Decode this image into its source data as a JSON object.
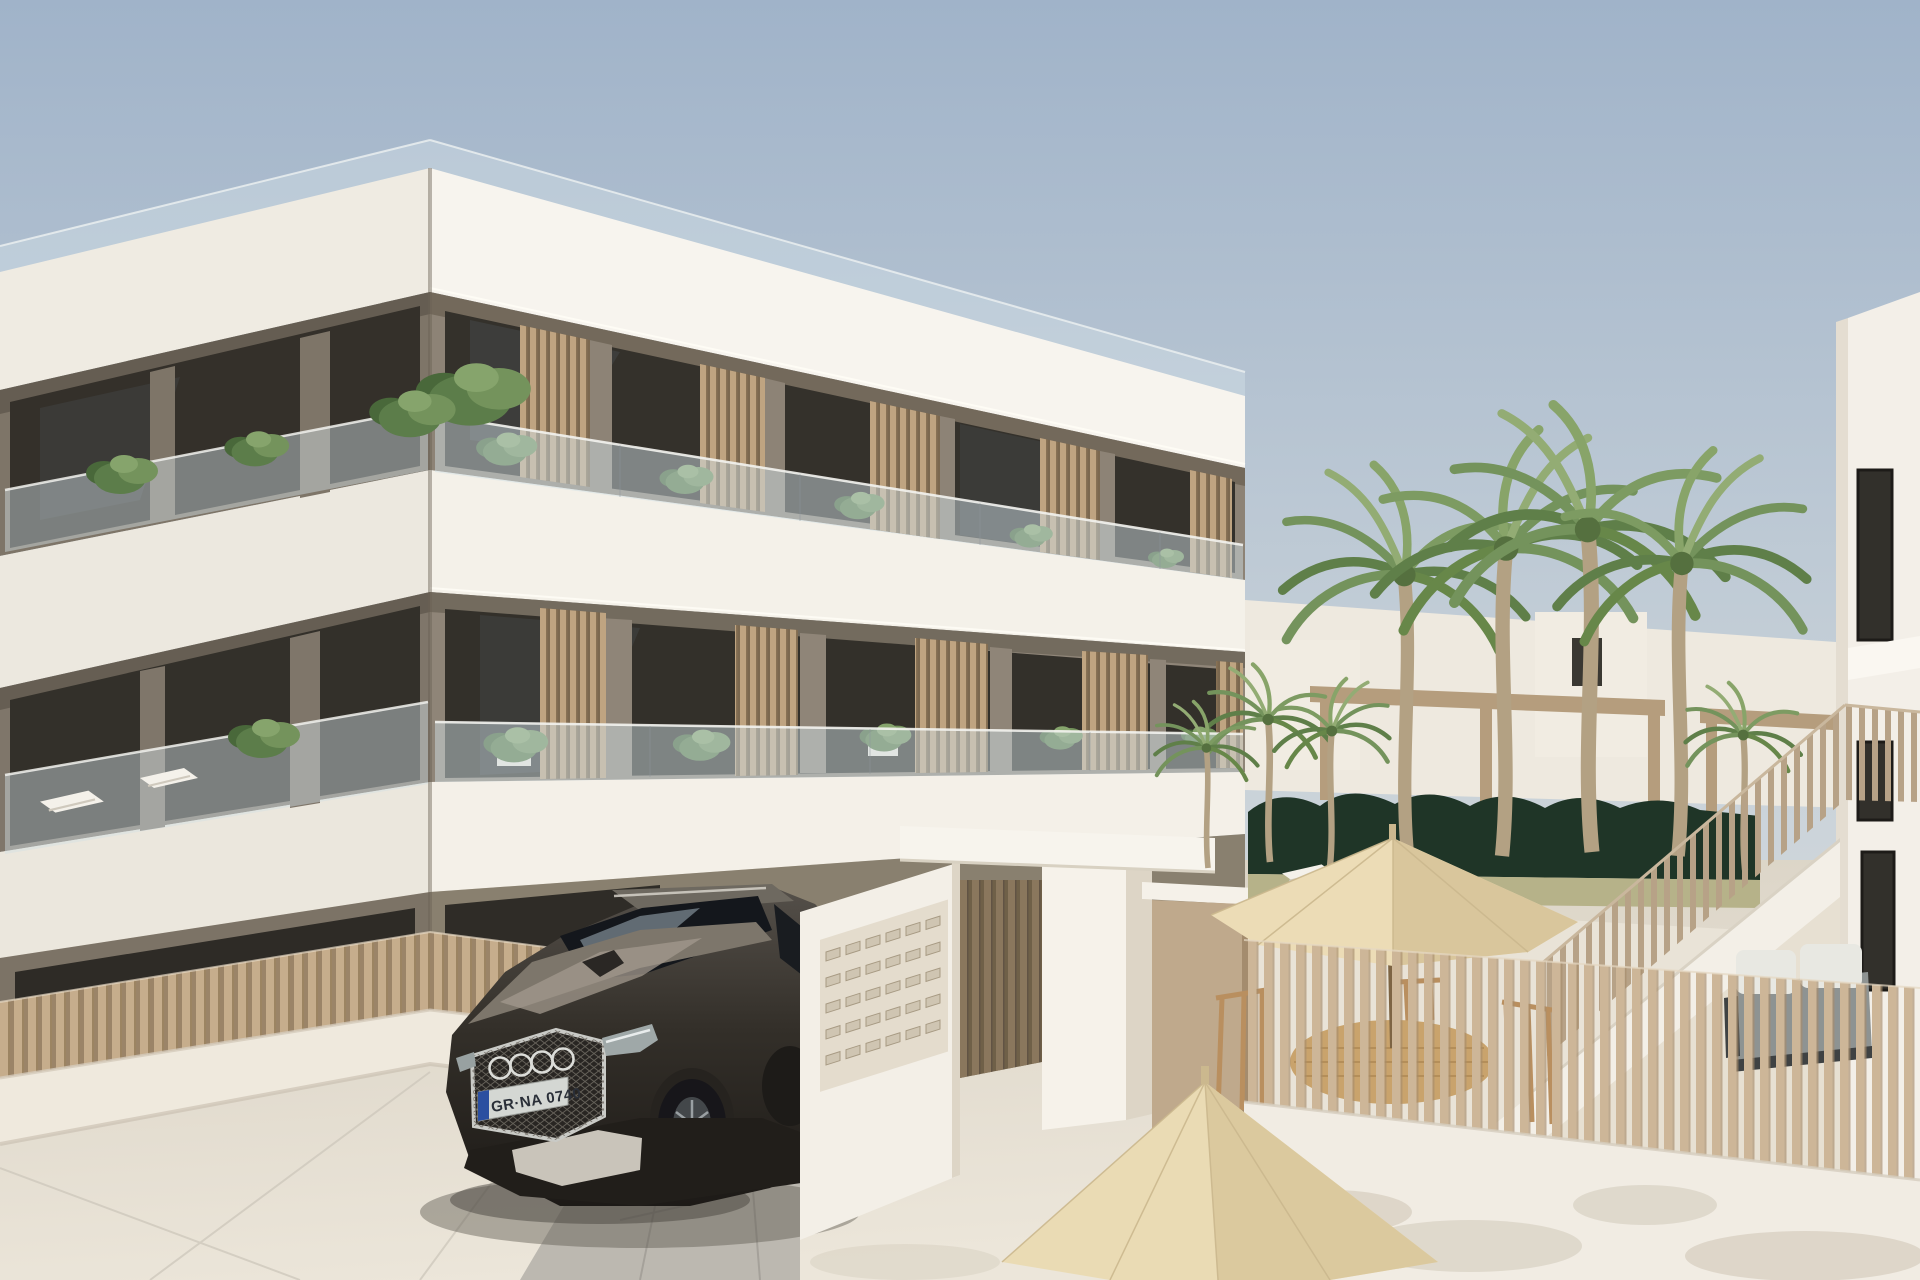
{
  "scene": {
    "title": "New-build apartment complex exterior 3D render",
    "setting": "clear daytime sky, Mediterranean residential street",
    "license_plate": {
      "text": "GR·NA 0740",
      "euro_band": true
    },
    "car": {
      "type": "SUV",
      "brand": "audi-four-rings",
      "body_color": "#3a352e"
    },
    "building": {
      "floors_visible": 3,
      "roof_terrace": true,
      "balcony_screens": "vertical wood slats",
      "balustrades": "frameless glass",
      "wall_color": "#8d8376",
      "slab_color": "#f4f1e9"
    },
    "street_furniture": {
      "mailbox_slots_rows": 5,
      "mailbox_slots_cols": 6
    },
    "courtyard": {
      "umbrellas": 3,
      "palm_trees_tall": 4,
      "palm_trees_small": 4,
      "hedge": "dark green",
      "furniture": [
        "wooden dining table",
        "wooden chairs",
        "sun loungers",
        "grey outdoor sofa"
      ],
      "fence": "vertical timber slats on white wall",
      "external_staircase": true
    },
    "palette": {
      "sky_top": "#a0b3c9",
      "sky_bottom": "#d8dcdd",
      "slab_white": "#f4f1e9",
      "wall_taupe": "#8d8376",
      "slat_wood": "#c9b192",
      "street": "#e2dbcf",
      "umbrella": "#ecdcb6",
      "hedge": "#1f3527",
      "palm_green": "#74935c",
      "car_dark": "#2a2622"
    }
  }
}
